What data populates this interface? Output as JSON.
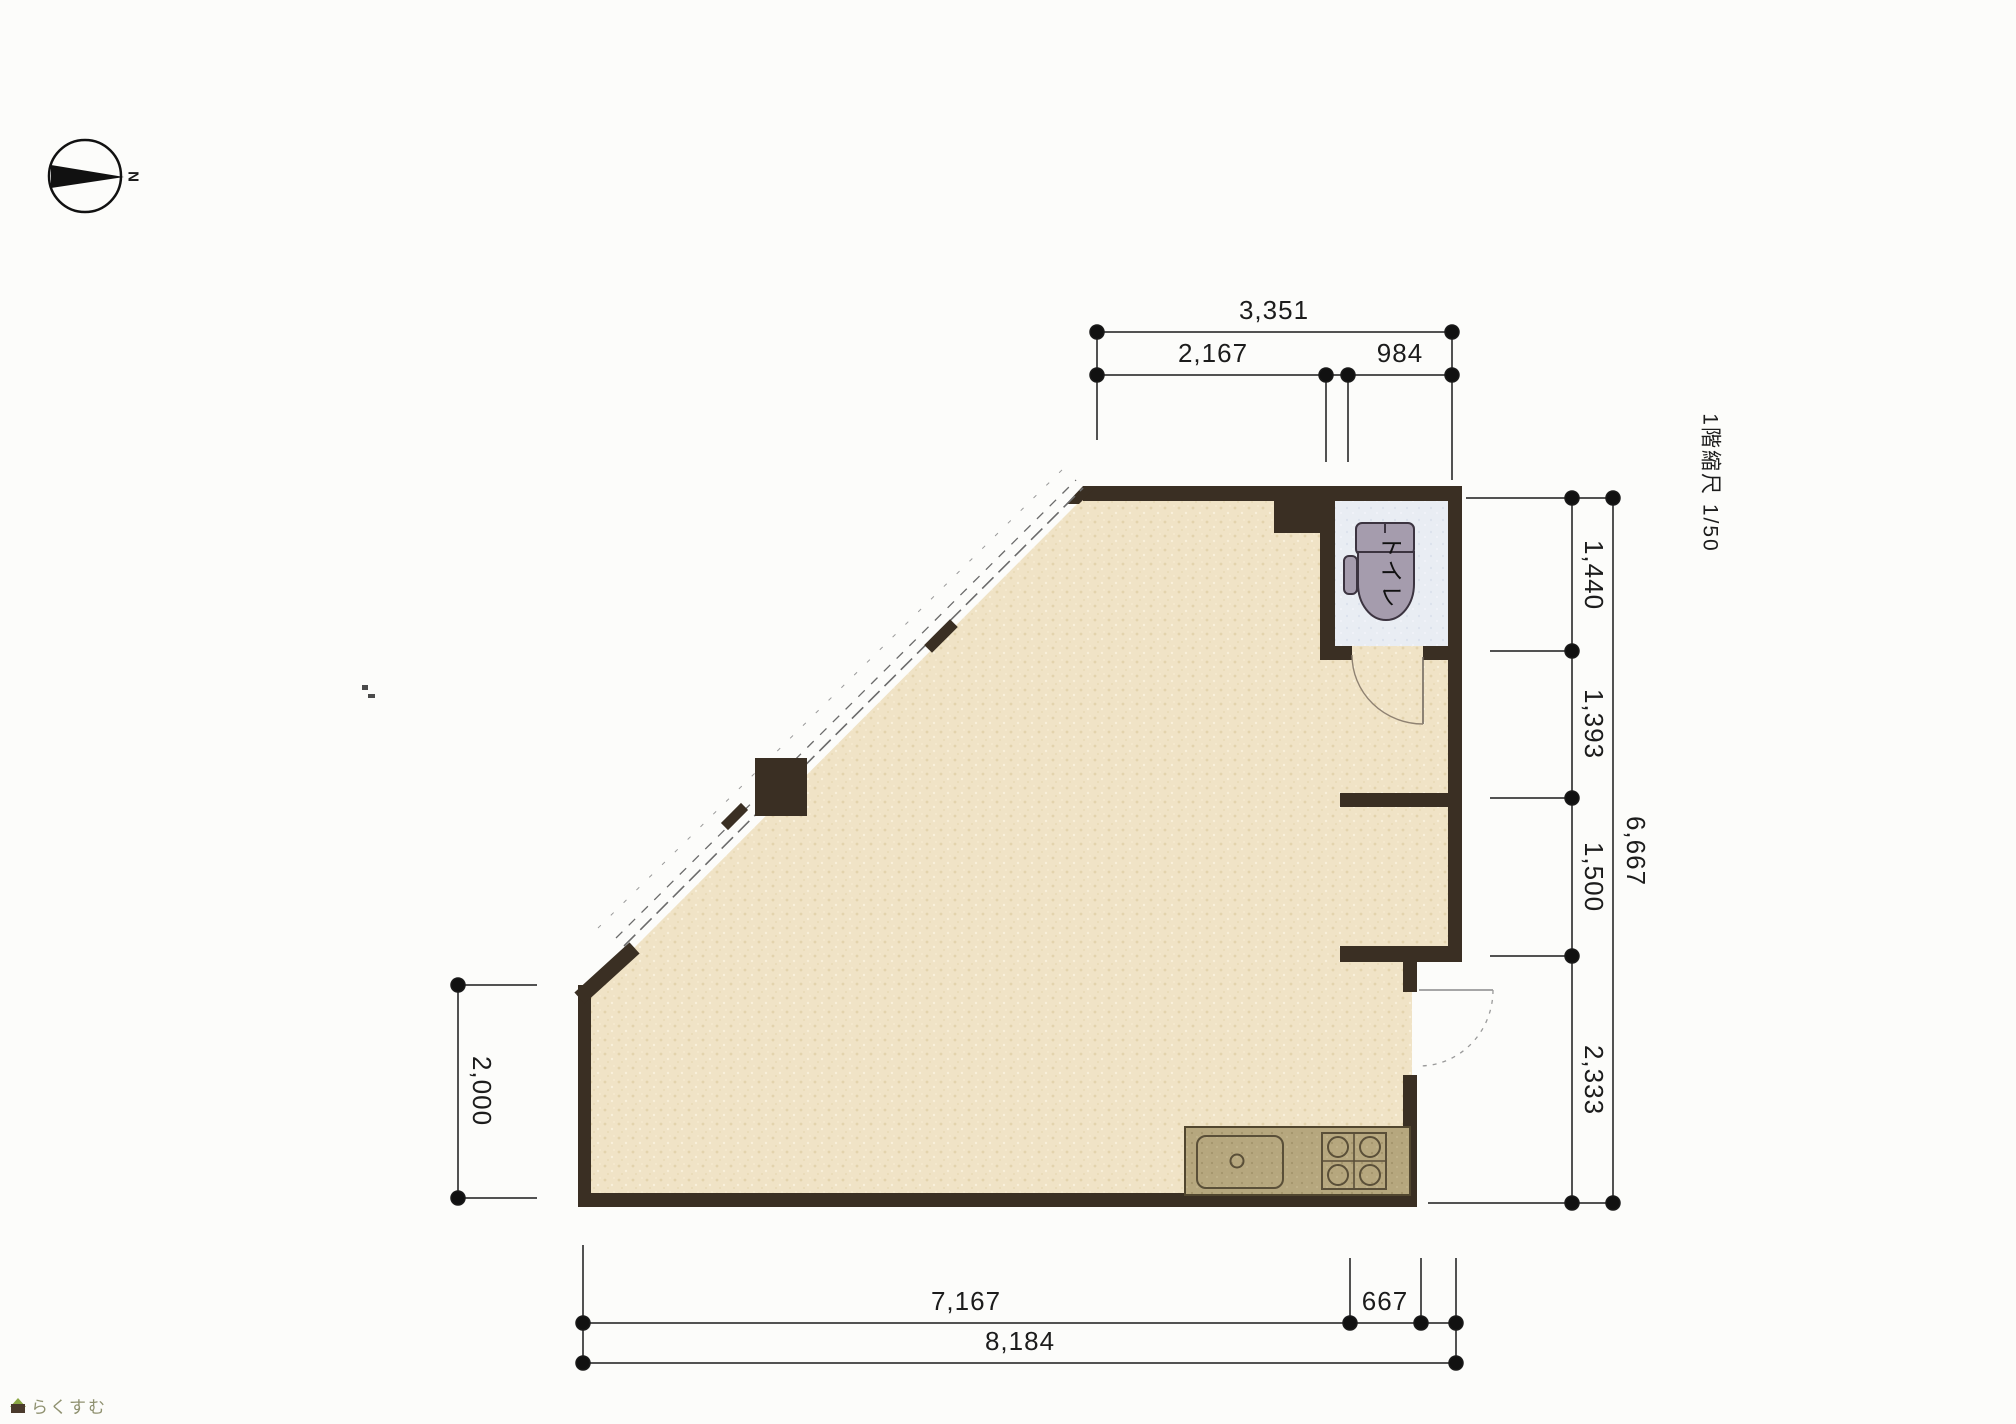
{
  "title_note": "1階縮尺 1/50",
  "compass": {
    "label": "N"
  },
  "dimensions": {
    "top": {
      "total": "3,351",
      "segments": [
        "2,167",
        "984"
      ]
    },
    "right": {
      "total": "6,667",
      "segments": [
        "1,440",
        "1,393",
        "1,500",
        "2,333"
      ]
    },
    "left": {
      "segments": [
        "2,000"
      ]
    },
    "bottom": {
      "total": "8,184",
      "segments": [
        "7,167",
        "667"
      ]
    }
  },
  "rooms": {
    "toilet_label": "トイレ"
  },
  "logo": {
    "text": "らくすむ"
  },
  "colors": {
    "wall": "#3a2f23",
    "floor": "#f0e3c6",
    "toilet_floor": "#e9edf3",
    "counter": "#b6a77e",
    "fixture": "#a59cad",
    "dim_line": "#1a1a1a",
    "logo_green": "#8aa743"
  }
}
